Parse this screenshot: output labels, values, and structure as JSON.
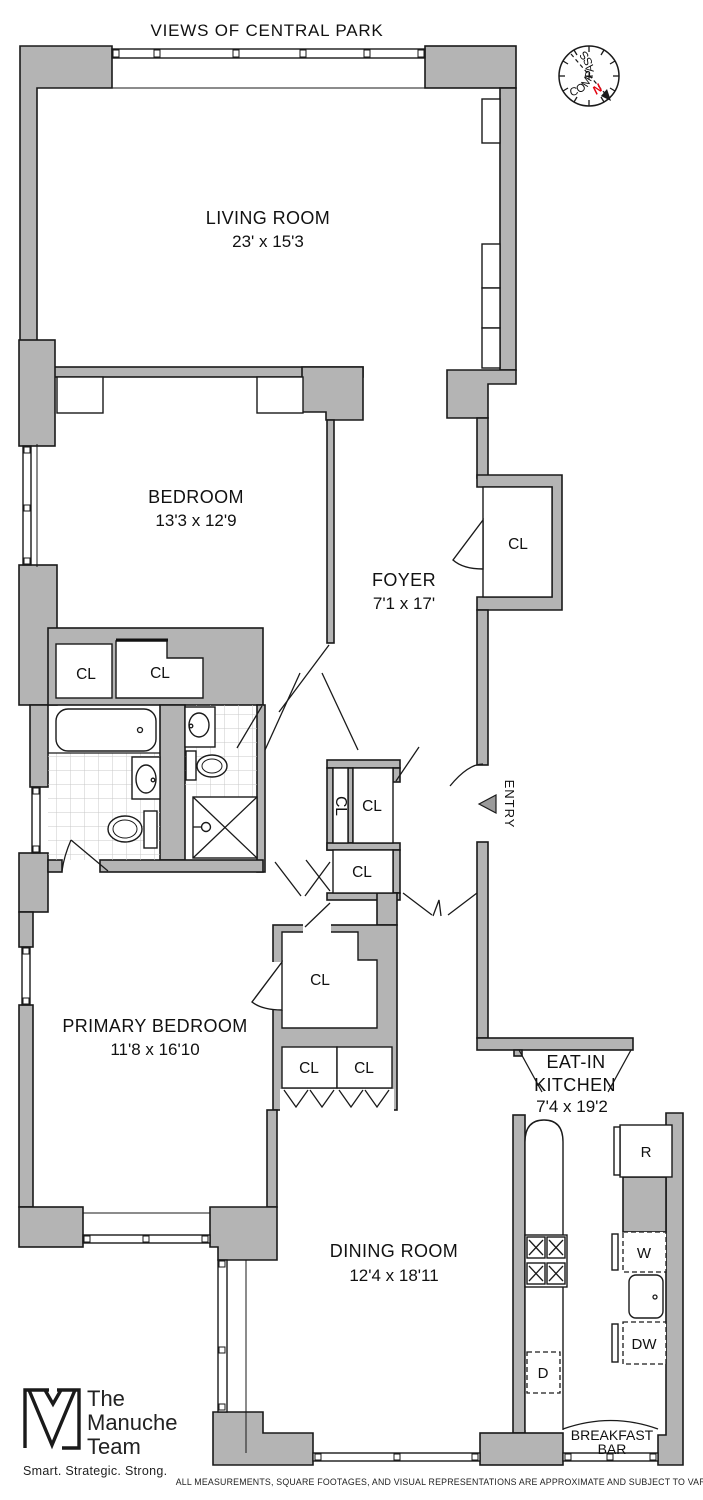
{
  "title": "VIEWS OF CENTRAL PARK",
  "compass": {
    "label": "COMPASS",
    "north": "N"
  },
  "rooms": {
    "living_room": {
      "name": "LIVING ROOM",
      "dims": "23' x 15'3"
    },
    "bedroom": {
      "name": "BEDROOM",
      "dims": "13'3 x 12'9"
    },
    "foyer": {
      "name": "FOYER",
      "dims": "7'1 x 17'"
    },
    "primary_bedroom": {
      "name": "PRIMARY BEDROOM",
      "dims": "11'8 x 16'10"
    },
    "dining_room": {
      "name": "DINING ROOM",
      "dims": "12'4 x 18'11"
    },
    "eat_in_kitchen": {
      "line1": "EAT-IN",
      "line2": "KITCHEN",
      "dims": "7'4 x 19'2"
    },
    "breakfast_bar": {
      "line1": "BREAKFAST",
      "line2": "BAR"
    }
  },
  "entry_label": "ENTRY",
  "closet_label": "CL",
  "appliances": {
    "refrigerator": "R",
    "washer": "W",
    "dishwasher": "DW",
    "dryer": "D"
  },
  "logo": {
    "word1": "The",
    "word2": "Manuche",
    "word3": "Team",
    "tagline": "Smart. Strategic. Strong."
  },
  "disclaimer": "ALL MEASUREMENTS, SQUARE FOOTAGES, AND VISUAL REPRESENTATIONS ARE APPROXIMATE AND SUBJECT TO VARIATION.",
  "colors": {
    "wall": "#b4b4b4",
    "line": "#1a1a1a",
    "north": "#e30613",
    "text": "#111111"
  }
}
